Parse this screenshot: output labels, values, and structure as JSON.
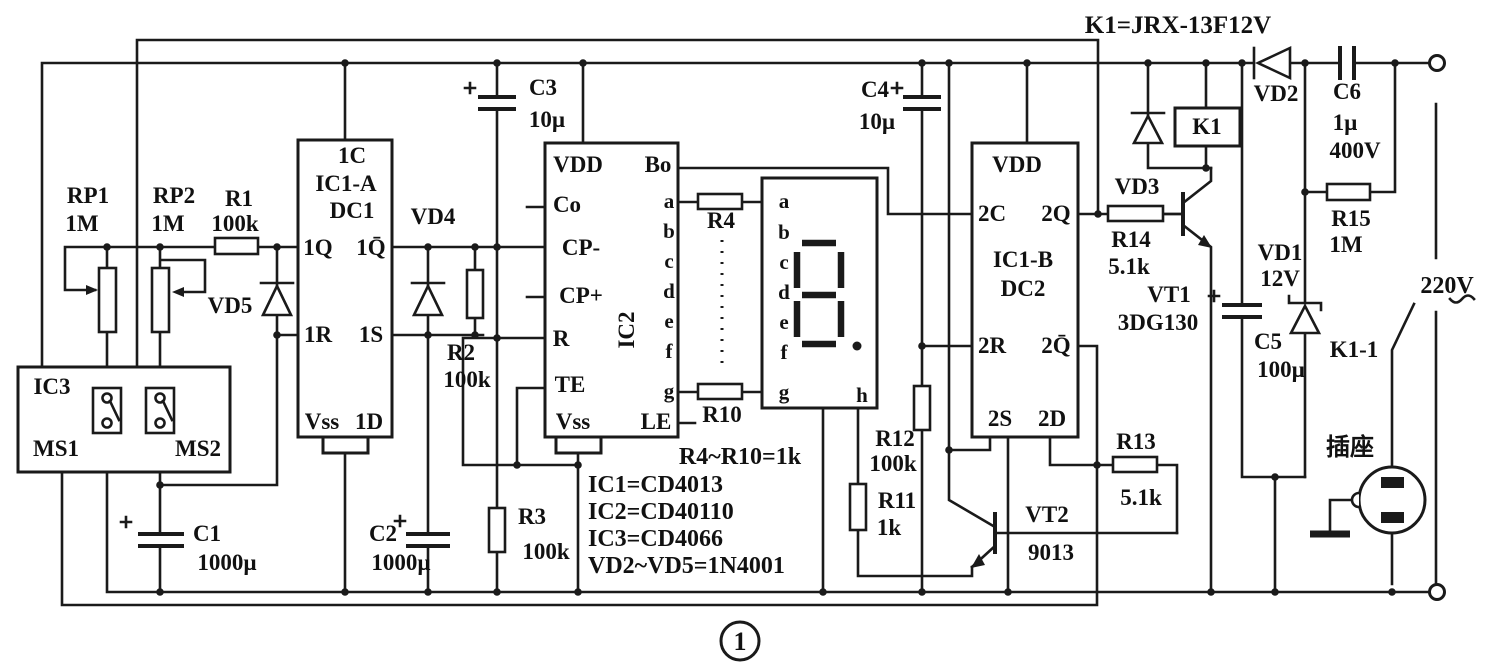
{
  "figure_number": "1",
  "colors": {
    "ink": "#1a1a1a",
    "paper": "#ffffff"
  },
  "labels": {
    "k1_model": "K1=JRX-13F12V",
    "rp1": "RP1",
    "rp1_value": "1M",
    "rp2": "RP2",
    "rp2_value": "1M",
    "r1": "R1",
    "r1_value": "100k",
    "r2": "R2",
    "r2_value": "100k",
    "r3": "R3",
    "r3_value": "100k",
    "r4": "R4",
    "r10": "R10",
    "r11": "R11",
    "r11_value": "1k",
    "r12": "R12",
    "r12_value": "100k",
    "r13": "R13",
    "r13_value": "5.1k",
    "r14": "R14",
    "r14_value": "5.1k",
    "r15": "R15",
    "r15_value": "1M",
    "c1": "C1",
    "c1_value": "1000µ",
    "c2": "C2",
    "c2_value": "1000µ",
    "c3": "C3",
    "c3_value": "10µ",
    "c4": "C4",
    "c4_value": "10µ",
    "c5": "C5",
    "c5_value": "100µ",
    "c6": "C6",
    "c6_value1": "1µ",
    "c6_value2": "400V",
    "vd1": "VD1",
    "vd1_value": "12V",
    "vd2": "VD2",
    "vd3": "VD3",
    "vd4": "VD4",
    "vd5": "VD5",
    "vt1": "VT1",
    "vt1_value": "3DG130",
    "vt2": "VT2",
    "vt2_value": "9013",
    "k1": "K1",
    "k1_contact": "K1-1",
    "mains_voltage": "220V",
    "socket": "插座",
    "ic3_name": "IC3",
    "ms1": "MS1",
    "ms2": "MS2",
    "ic1a_pin_top": "1C",
    "ic1a_name": "IC1-A",
    "ic1a_sub": "DC1",
    "ic1a_1q": "1Q",
    "ic1a_1qbar": "1Q̄",
    "ic1a_1r": "1R",
    "ic1a_1s": "1S",
    "ic1a_vss": "Vss",
    "ic1a_1d": "1D",
    "ic2_vdd": "VDD",
    "ic2_co": "Co",
    "ic2_cpminus": "CP-",
    "ic2_cpplus": "CP+",
    "ic2_r": "R",
    "ic2_name": "IC2",
    "ic2_te": "TE",
    "ic2_vss": "Vss",
    "ic2_bo": "Bo",
    "ic2_le": "LE",
    "pin_letters": [
      "a",
      "b",
      "c",
      "d",
      "e",
      "f",
      "g"
    ],
    "disp_h": "h",
    "ic1b_vdd": "VDD",
    "ic1b_2c": "2C",
    "ic1b_2q": "2Q",
    "ic1b_name": "IC1-B",
    "ic1b_sub": "DC2",
    "ic1b_2r": "2R",
    "ic1b_2qbar": "2Q̄",
    "ic1b_2s": "2S",
    "ic1b_2d": "2D",
    "note_resistors": "R4~R10=1k",
    "note_ic1": "IC1=CD4013",
    "note_ic2": "IC2=CD40110",
    "note_ic3": "IC3=CD4066",
    "note_diodes": "VD2~VD5=1N4001"
  }
}
